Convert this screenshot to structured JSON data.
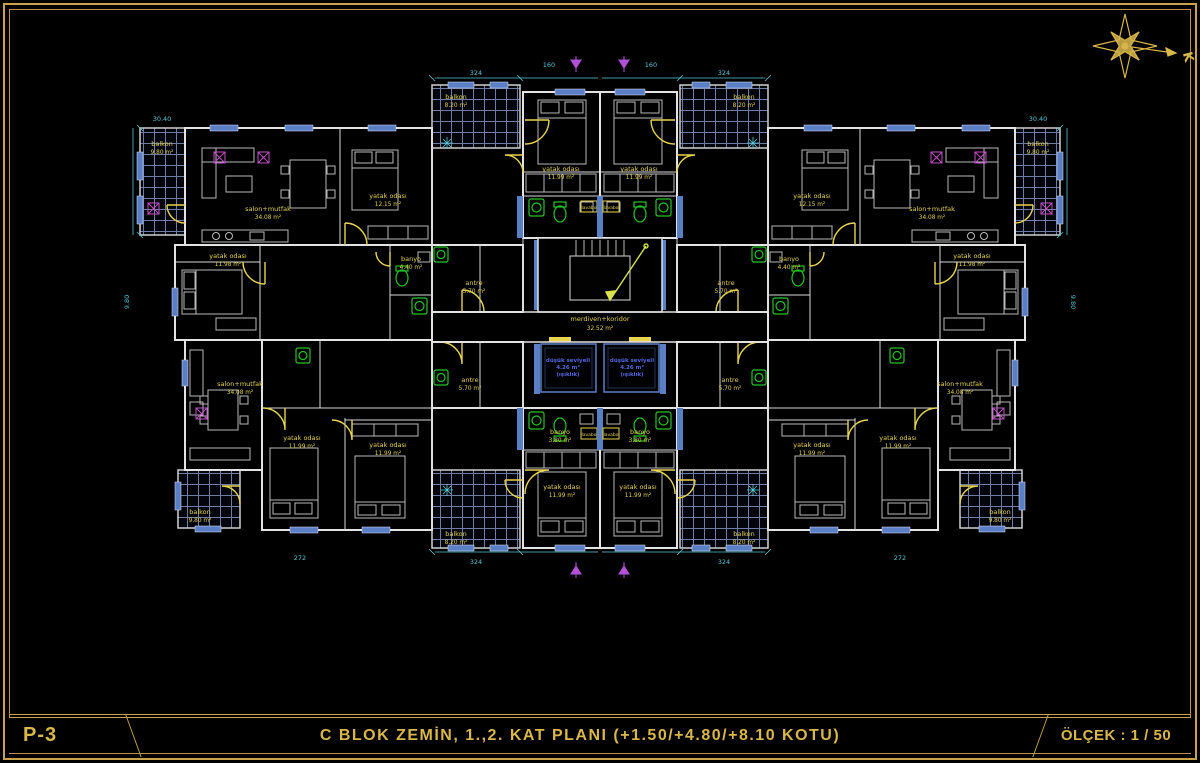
{
  "sheet": {
    "code": "P-3",
    "title": "C  BLOK  ZEMİN, 1.,2.  KAT  PLANI  (+1.50/+4.80/+8.10 KOTU)",
    "scale": "ÖLÇEK : 1 / 50",
    "north_letter": "K"
  },
  "colors": {
    "paper": "#000000",
    "frame": "#c9a24a",
    "walls": "#e3e3e3",
    "room_labels": "#e5d24e",
    "dimensions": "#55c8d8",
    "doors": "#e8d44d",
    "fixtures": "#23c423",
    "windows": "#5b7fc4",
    "accent": "#c44fc9",
    "shaft_text": "#5566dd",
    "hatch": "#6d7da3"
  },
  "rooms": [
    {
      "name": "balkon",
      "area": "9.80 m²"
    },
    {
      "name": "salon+mutfak",
      "area": "34.08 m²"
    },
    {
      "name": "yatak odası",
      "area": "12.15 m²"
    },
    {
      "name": "yatak odası",
      "area": "11.98 m²"
    },
    {
      "name": "banyo",
      "area": "4.40 m²"
    },
    {
      "name": "balkon",
      "area": "8.20 m²"
    },
    {
      "name": "yatak odası",
      "area": "11.99 m²"
    },
    {
      "name": "yatak odası",
      "area": "11.99 m²"
    },
    {
      "name": "balkon",
      "area": "8.20 m²"
    },
    {
      "name": "yatak odası",
      "area": "12.15 m²"
    },
    {
      "name": "salon+mutfak",
      "area": "34.08 m²"
    },
    {
      "name": "balkon",
      "area": "9.80 m²"
    },
    {
      "name": "banyo",
      "area": "4.40 m²"
    },
    {
      "name": "yatak odası",
      "area": "11.98 m²"
    },
    {
      "name": "merdiven+koridor",
      "area": "32.52 m²"
    },
    {
      "name": "düşük seviyeli",
      "area": "4.26 m²"
    },
    {
      "name": "düşük seviyeli",
      "area": "4.26 m²"
    },
    {
      "name": "antre",
      "area": "5.70 m²"
    },
    {
      "name": "antre",
      "area": "5.70 m²"
    },
    {
      "name": "antre",
      "area": "5.70 m²"
    },
    {
      "name": "antre",
      "area": "5.70 m²"
    },
    {
      "name": "salon+mutfak",
      "area": "34.08 m²"
    },
    {
      "name": "yatak odası",
      "area": "11.99 m²"
    },
    {
      "name": "yatak odası",
      "area": "11.99 m²"
    },
    {
      "name": "banyo",
      "area": "3.80 m²"
    },
    {
      "name": "banyo",
      "area": "3.80 m²"
    },
    {
      "name": "yatak odası",
      "area": "11.99 m²"
    },
    {
      "name": "yatak odası",
      "area": "11.99 m²"
    },
    {
      "name": "salon+mutfak",
      "area": "34.08 m²"
    },
    {
      "name": "yatak odası",
      "area": "11.99 m²"
    },
    {
      "name": "yatak odası",
      "area": "11.99 m²"
    },
    {
      "name": "balkon",
      "area": "9.80 m²"
    },
    {
      "name": "balkon",
      "area": "9.80 m²"
    },
    {
      "name": "balkon",
      "area": "8.20 m²"
    },
    {
      "name": "balkon",
      "area": "8.20 m²"
    },
    {
      "name": "lavabo"
    },
    {
      "name": "lavabo"
    },
    {
      "name": "lavabo"
    },
    {
      "name": "lavabo"
    }
  ],
  "shaft_note": "(ışıklık)",
  "dims": [
    "324",
    "324",
    "160",
    "160",
    "30.40",
    "30.40",
    "9.80",
    "9.80",
    "272",
    "272",
    "324",
    "324"
  ]
}
